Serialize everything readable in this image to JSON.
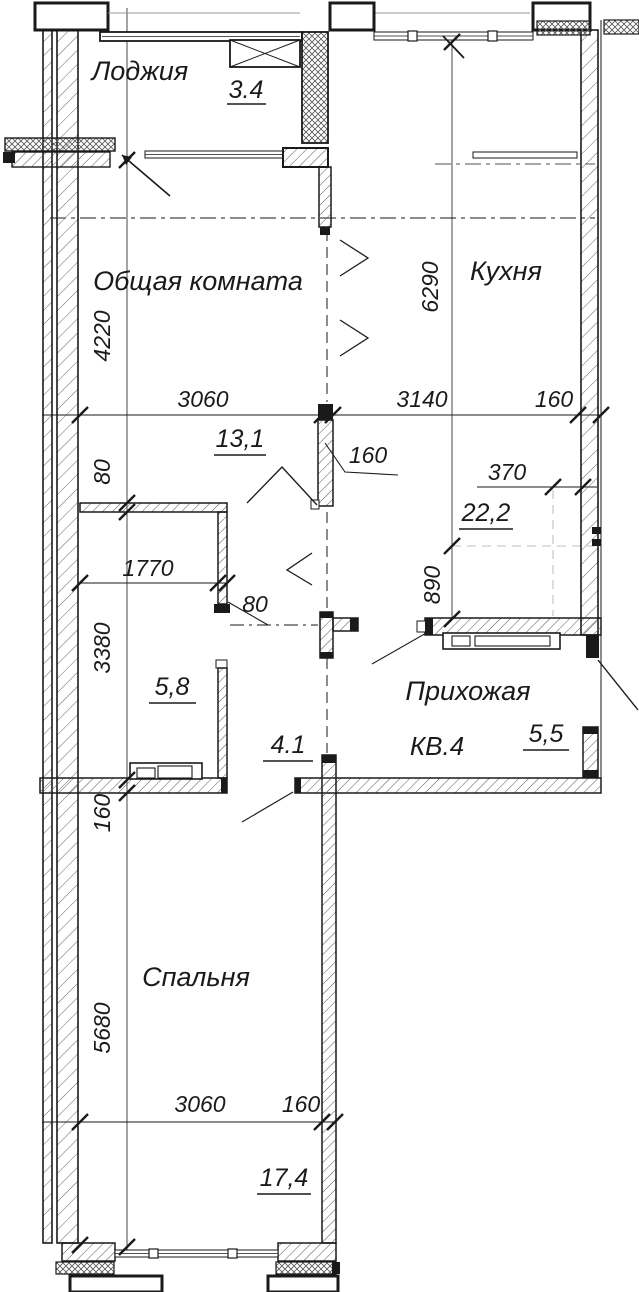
{
  "plan": {
    "type": "apartment-floor-plan",
    "apartment": "КВ.4",
    "rooms": [
      {
        "name": "Лоджия",
        "area": "3.4"
      },
      {
        "name": "Общая комната",
        "area": "13,1"
      },
      {
        "name": "Кухня",
        "area": "22,2"
      },
      {
        "name": "Прихожая",
        "area": "5,5"
      },
      {
        "name": "Спальня",
        "area": "17,4"
      },
      {
        "name": "Кладовая",
        "area": "5,8"
      },
      {
        "name": "Коридор",
        "area": "4.1"
      }
    ],
    "texts": {
      "loggia_name": "Лоджия",
      "loggia_area": "3.4",
      "living_name": "Общая комната",
      "living_area": "13,1",
      "kitchen_name": "Кухня",
      "kitchen_area": "22,2",
      "hall_name": "Прихожая",
      "hall_area": "5,5",
      "bedroom_name": "Спальня",
      "bedroom_area": "17,4",
      "closet_area": "5,8",
      "corridor_area": "4.1",
      "apartment": "КВ.4",
      "dim_4220": "4220",
      "dim_3060_top": "3060",
      "dim_3140": "3140",
      "dim_160_top": "160",
      "dim_6290": "6290",
      "dim_80_top": "80",
      "dim_1770": "1770",
      "dim_80_leader": "80",
      "dim_3380": "3380",
      "dim_370": "370",
      "dim_890": "890",
      "dim_160_wall": "160",
      "dim_160_bed": "160",
      "dim_5680": "5680",
      "dim_3060_bot": "3060",
      "dim_160_bot": "160"
    },
    "colors": {
      "line": "#1a1a1a",
      "hatch": "#555555",
      "gray": "#9a9a9a",
      "background": "#ffffff"
    }
  }
}
